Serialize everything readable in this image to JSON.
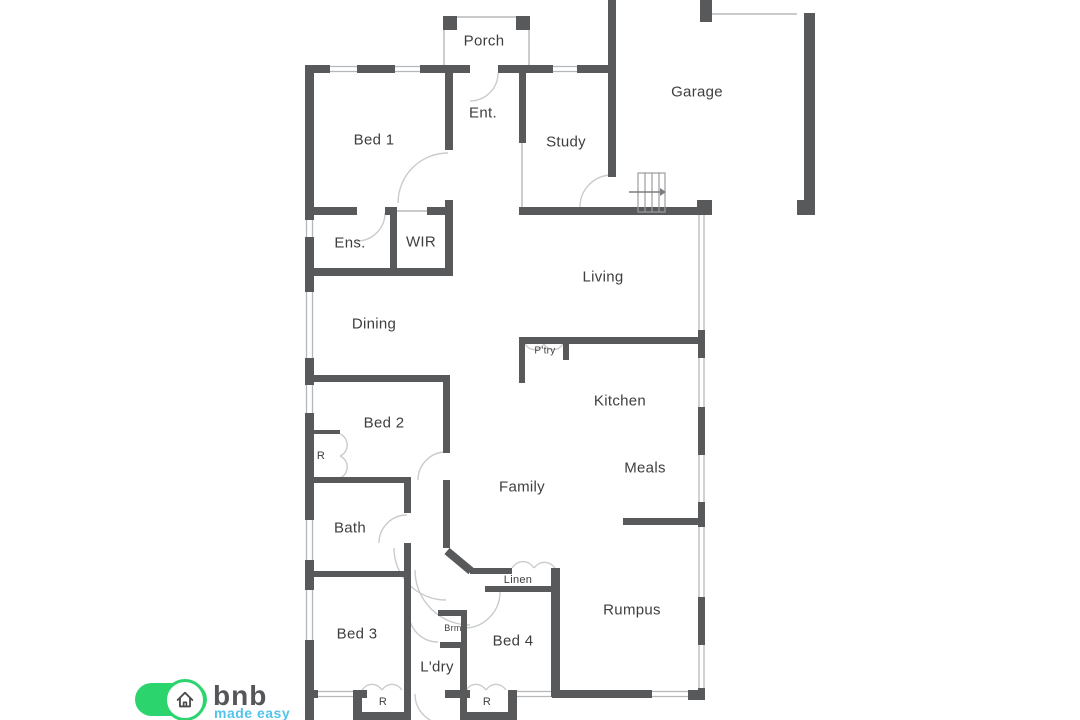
{
  "title": "Residential floor plan",
  "colors": {
    "wall": "#58595b",
    "window_line": "#b5b8ba",
    "arc": "#c9cbcd",
    "text": "#3d3e40",
    "logo_green": "#2cd46e",
    "logo_blue": "#53c3eb",
    "logo_gray": "#55565a"
  },
  "rooms": {
    "porch": "Porch",
    "ent": "Ent.",
    "bed1": "Bed 1",
    "study": "Study",
    "garage": "Garage",
    "ens": "Ens.",
    "wir": "WIR",
    "living": "Living",
    "dining": "Dining",
    "pantry": "P'try",
    "kitchen": "Kitchen",
    "bed2": "Bed 2",
    "meals": "Meals",
    "family": "Family",
    "bath": "Bath",
    "linen": "Linen",
    "rumpus": "Rumpus",
    "brm": "Brm",
    "bed3": "Bed 3",
    "bed4": "Bed 4",
    "ldry": "L'dry",
    "robe": "R"
  },
  "logo": {
    "brand": "bnb",
    "tagline": "made easy"
  }
}
